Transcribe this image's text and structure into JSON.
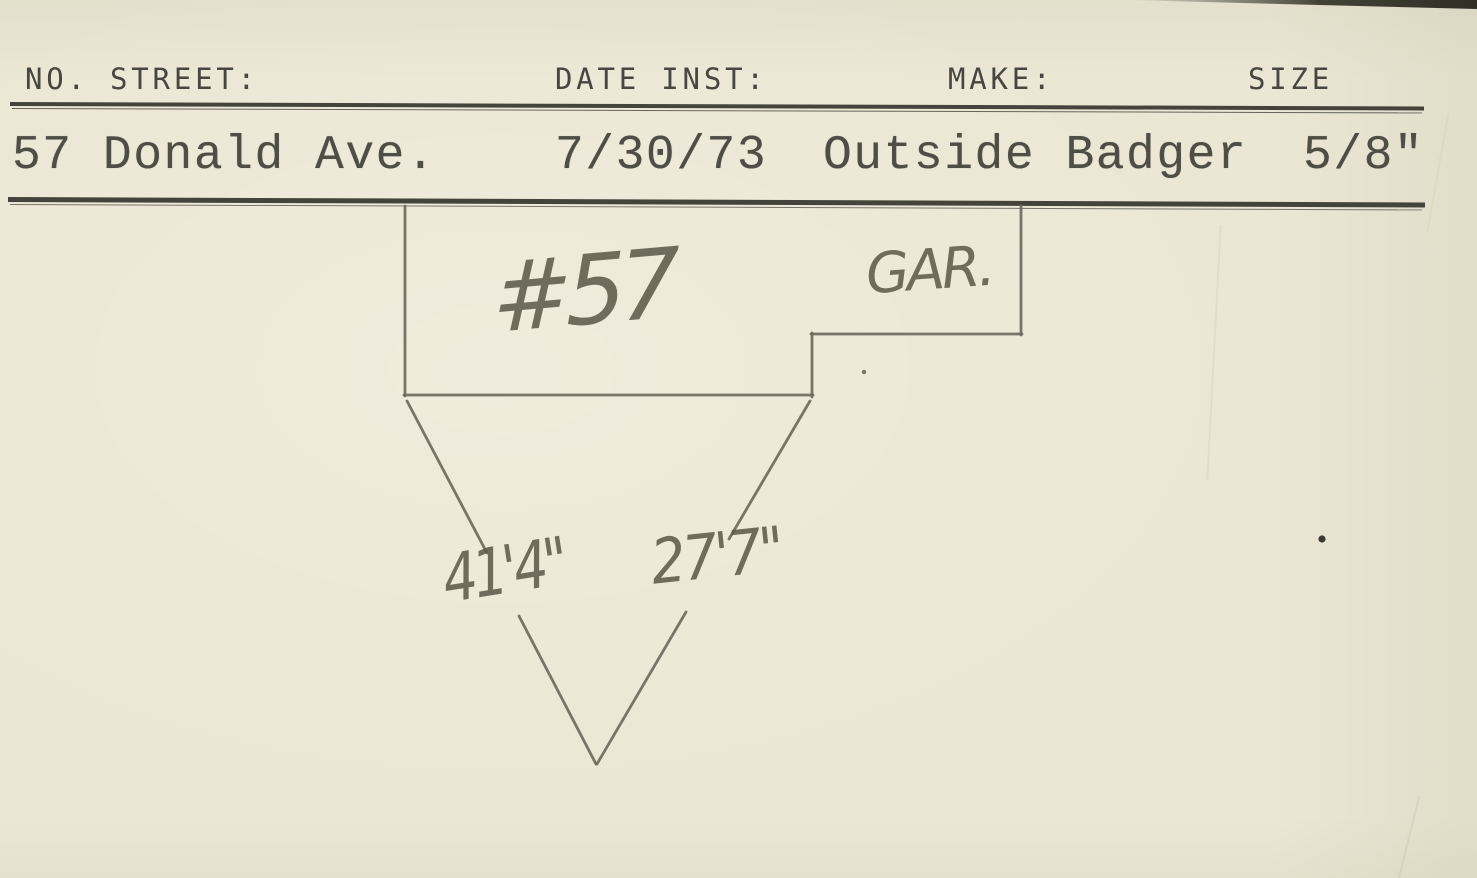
{
  "card": {
    "header": {
      "no_street_label": "NO. STREET:",
      "date_inst_label": "DATE INST:",
      "make_label": "MAKE:",
      "size_label": "SIZE"
    },
    "record": {
      "no_street": "57 Donald Ave.",
      "date_inst": "7/30/73",
      "make": "Outside Badger",
      "size": "5/8\""
    },
    "sketch": {
      "house_number_label": "#57",
      "garage_label": "GAR.",
      "tie_measurement_left": "41'4\"",
      "tie_measurement_right": "27'7\""
    },
    "colors": {
      "paper": "#ebe7d4",
      "typed_ink": "#4e4e45",
      "header_ink": "#47473f",
      "pencil": "#6b6a5d",
      "rule": "#45443c"
    }
  }
}
